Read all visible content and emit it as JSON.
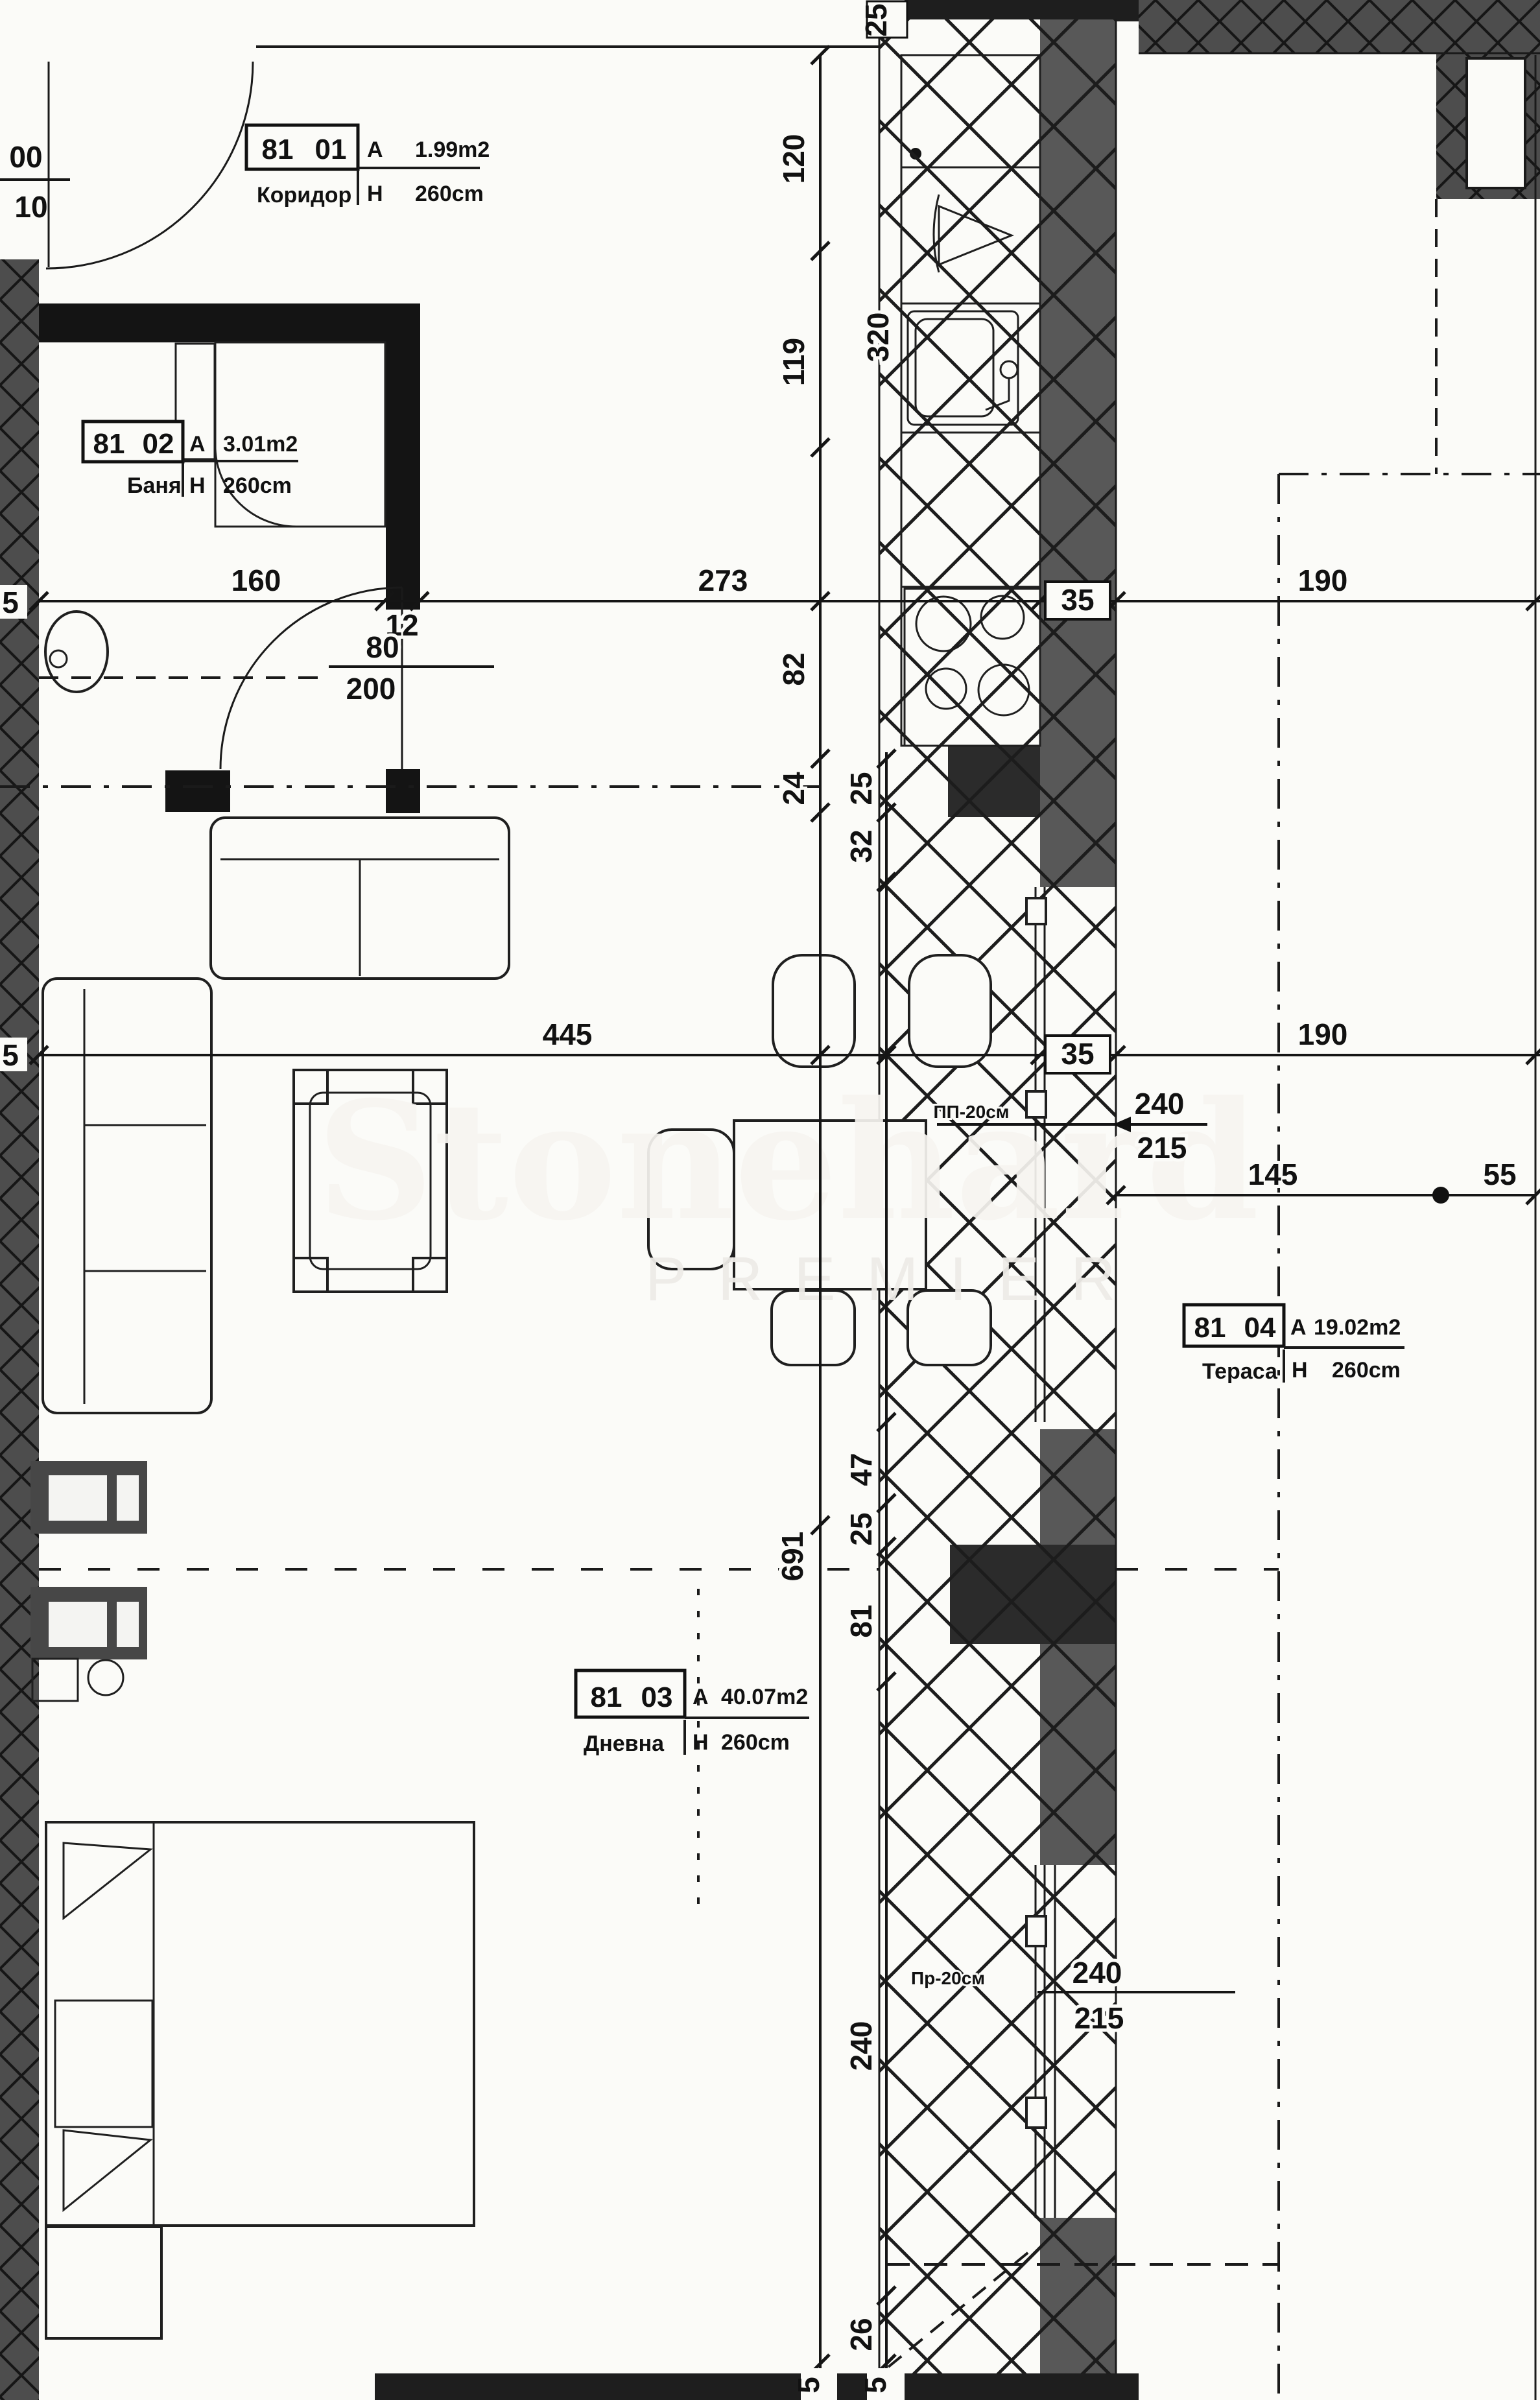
{
  "watermark": {
    "brand": "Stonehard",
    "premier": "PREMIER"
  },
  "labels": {
    "area_prefix": "A",
    "height_prefix": "H"
  },
  "rooms": {
    "hall": {
      "num1": "81",
      "num2": "01",
      "name": "Коридор",
      "area": "1.99m2",
      "height": "260cm"
    },
    "bath": {
      "num1": "81",
      "num2": "02",
      "name": "Баня",
      "area": "3.01m2",
      "height": "260cm"
    },
    "living": {
      "num1": "81",
      "num2": "03",
      "name": "Дневна",
      "area": "40.07m2",
      "height": "260cm"
    },
    "terrace": {
      "num1": "81",
      "num2": "04",
      "name": "Тераса",
      "area": "19.02m2",
      "height": "260cm"
    }
  },
  "dims": {
    "v120": "120",
    "v119": "119",
    "v320": "320",
    "v82": "82",
    "v24": "24",
    "v25a": "25",
    "v32": "32",
    "v47": "47",
    "v25b": "25",
    "v81": "81",
    "v691": "691",
    "v240": "240",
    "v26": "26",
    "h160": "160",
    "h12": "12",
    "h273": "273",
    "h35a": "35",
    "h190a": "190",
    "h80": "80",
    "h200": "200",
    "h445": "445",
    "h35b": "35",
    "h190b": "190",
    "f240a": "240",
    "f215a": "215",
    "f240b": "240",
    "f215b": "215",
    "h145": "145",
    "h55": "55",
    "top25": "25",
    "frac00": "00",
    "frac10": "10",
    "w5a": "5",
    "w5b": "5",
    "b5a": "5",
    "b5b": "5",
    "pp": "ПП-20см",
    "pr": "Пр-20см"
  }
}
